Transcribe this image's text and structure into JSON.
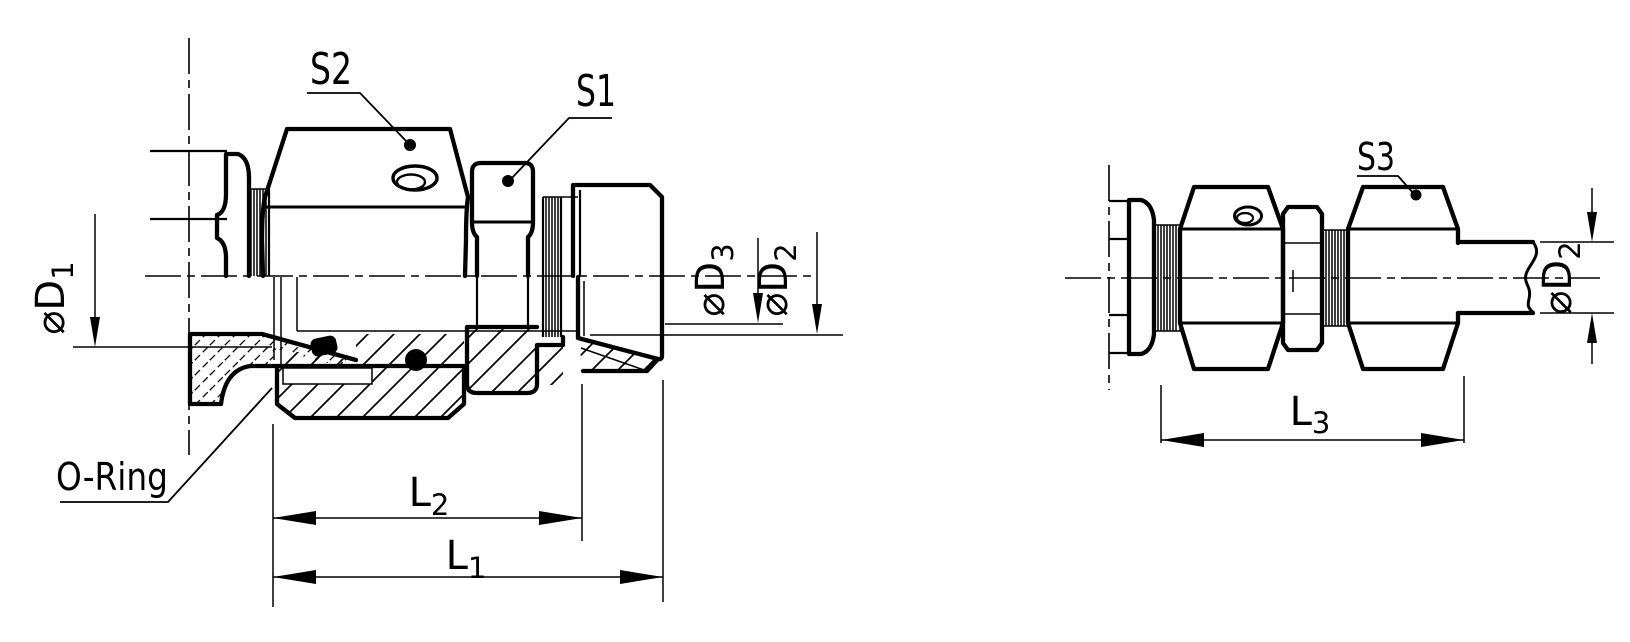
{
  "figure": {
    "type": "technical-drawing",
    "background": "#ffffff",
    "line_color": "#000000"
  },
  "left_view": {
    "callouts": {
      "s2": "S2",
      "s1": "S1",
      "o_ring": "O-Ring"
    },
    "dimensions": {
      "d1": {
        "base": "⌀D",
        "sub": "1"
      },
      "d3": {
        "base": "⌀D",
        "sub": "3"
      },
      "d2": {
        "base": "⌀D",
        "sub": "2"
      },
      "l2": {
        "base": "L",
        "sub": "2"
      },
      "l1": {
        "base": "L",
        "sub": "1"
      }
    }
  },
  "right_view": {
    "callouts": {
      "s3": "S3"
    },
    "dimensions": {
      "d2": {
        "base": "⌀D",
        "sub": "2"
      },
      "l3": {
        "base": "L",
        "sub": "3"
      }
    }
  }
}
